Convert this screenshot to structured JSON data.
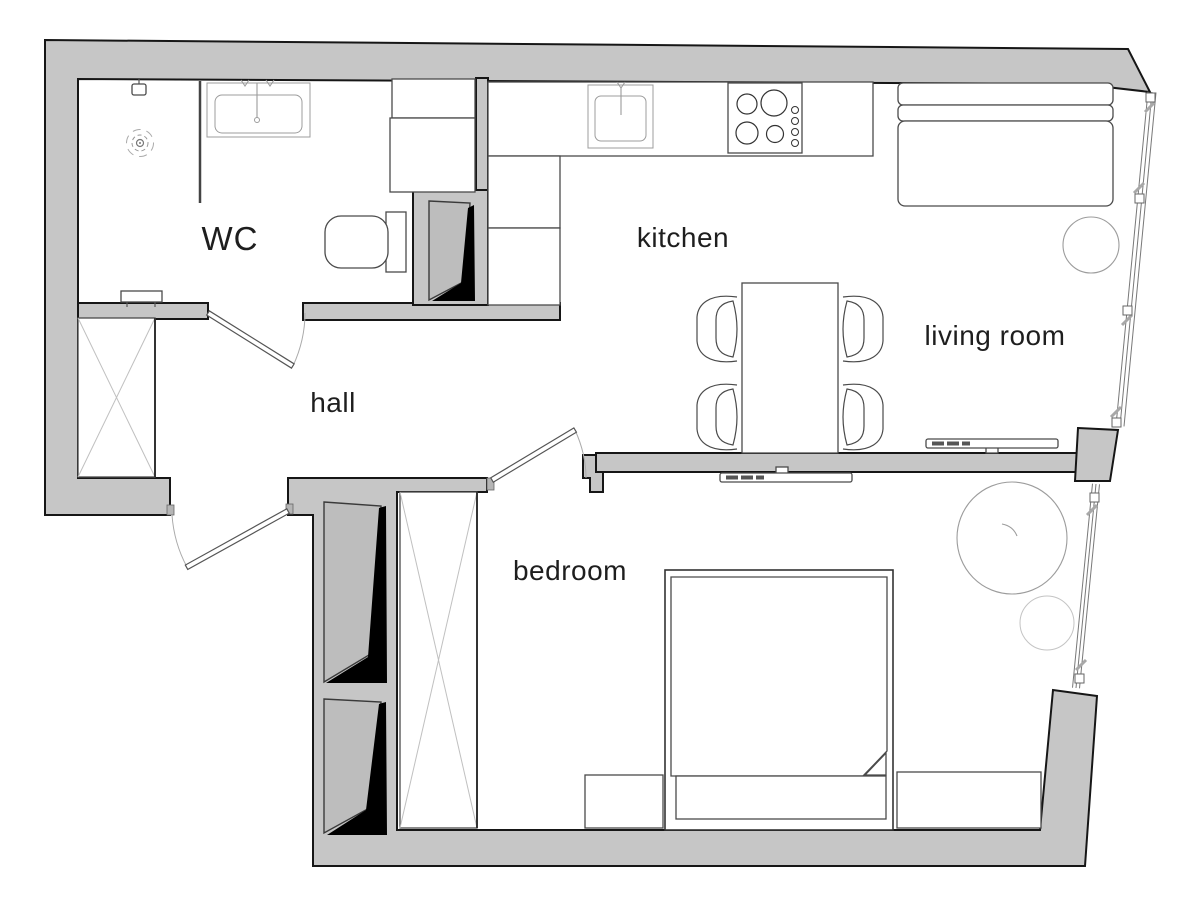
{
  "rooms": [
    {
      "id": "wc",
      "label": "WC"
    },
    {
      "id": "kitchen",
      "label": "kitchen"
    },
    {
      "id": "living_room",
      "label": "living room"
    },
    {
      "id": "hall",
      "label": "hall"
    },
    {
      "id": "bedroom",
      "label": "bedroom"
    }
  ],
  "colors": {
    "wall_fill": "#c6c6c6",
    "wall_outline": "#161616",
    "furniture_stroke": "#4a4a4a",
    "light_stroke": "#9c9c9c",
    "shaft_black": "#000000",
    "label_color": "#1e1e1e",
    "background": "#ffffff"
  }
}
